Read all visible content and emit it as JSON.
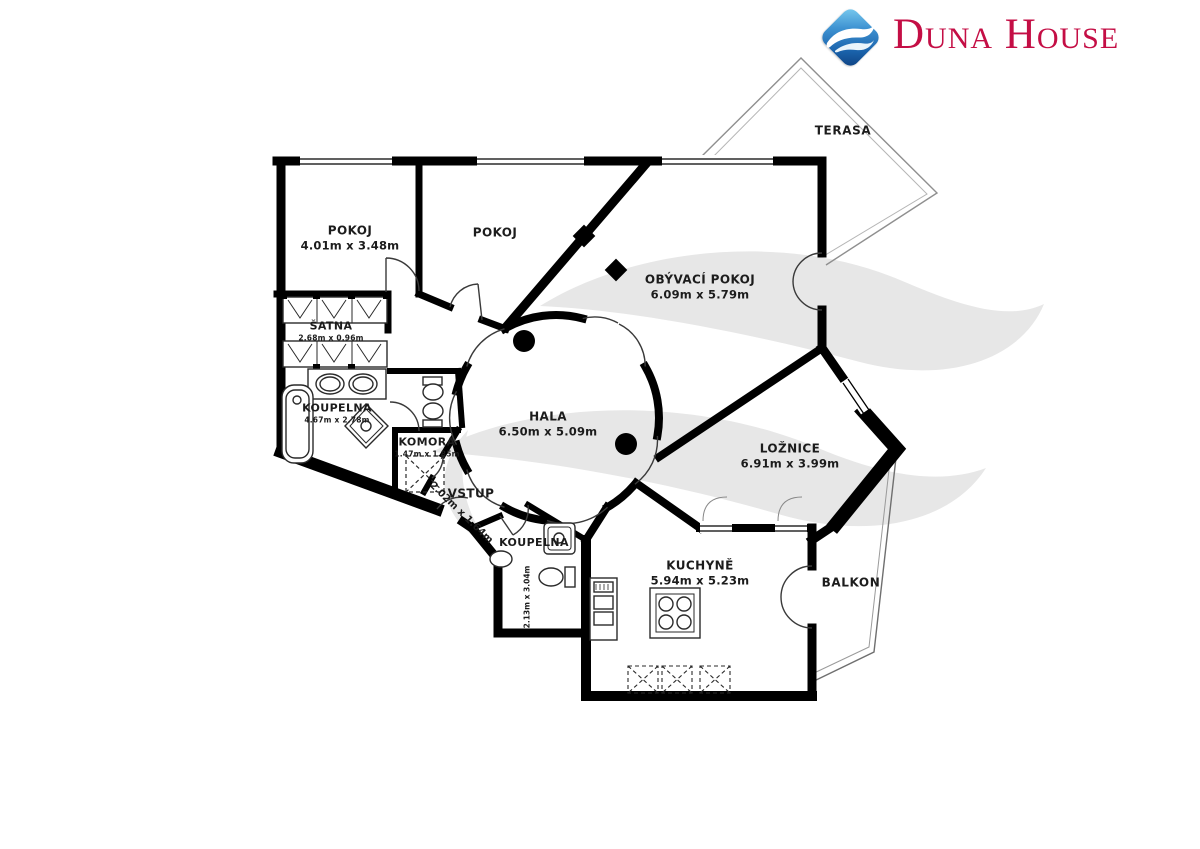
{
  "brand": {
    "name": "Duna House",
    "logo_icon": "wave-diamond-icon",
    "color": "#C40E45"
  },
  "floorplan": {
    "watermark_icon": "wave-watermark",
    "colors": {
      "walls": "#000000",
      "watermark": "#E7E7E7",
      "outline": "#999999"
    },
    "rooms": {
      "pokoj1": {
        "name": "POKOJ",
        "dims": "4.01m x 3.48m"
      },
      "pokoj2": {
        "name": "POKOJ"
      },
      "obyvaci": {
        "name": "OBÝVACÍ POKOJ",
        "dims": "6.09m x 5.79m"
      },
      "terasa": {
        "name": "TERASA"
      },
      "satna": {
        "name": "ŠATNA",
        "dims": "2.68m x 0.96m"
      },
      "koupelna1": {
        "name": "KOUPELNA",
        "dims": "4.67m x 2.78m"
      },
      "hala": {
        "name": "HALA",
        "dims": "6.50m x 5.09m"
      },
      "komora": {
        "name": "KOMORA",
        "dims": "1.47m x 1.85m"
      },
      "vstup": {
        "name": "VSTUP",
        "dims": "2.02m x 1.64m"
      },
      "koupelna2": {
        "name": "KOUPELNA",
        "dims": "2.13m x 3.04m"
      },
      "loznice": {
        "name": "LOŽNICE",
        "dims": "6.91m x 3.99m"
      },
      "kuchyne": {
        "name": "KUCHYNĚ",
        "dims": "5.94m x 5.23m"
      },
      "balkon": {
        "name": "BALKON"
      }
    }
  }
}
